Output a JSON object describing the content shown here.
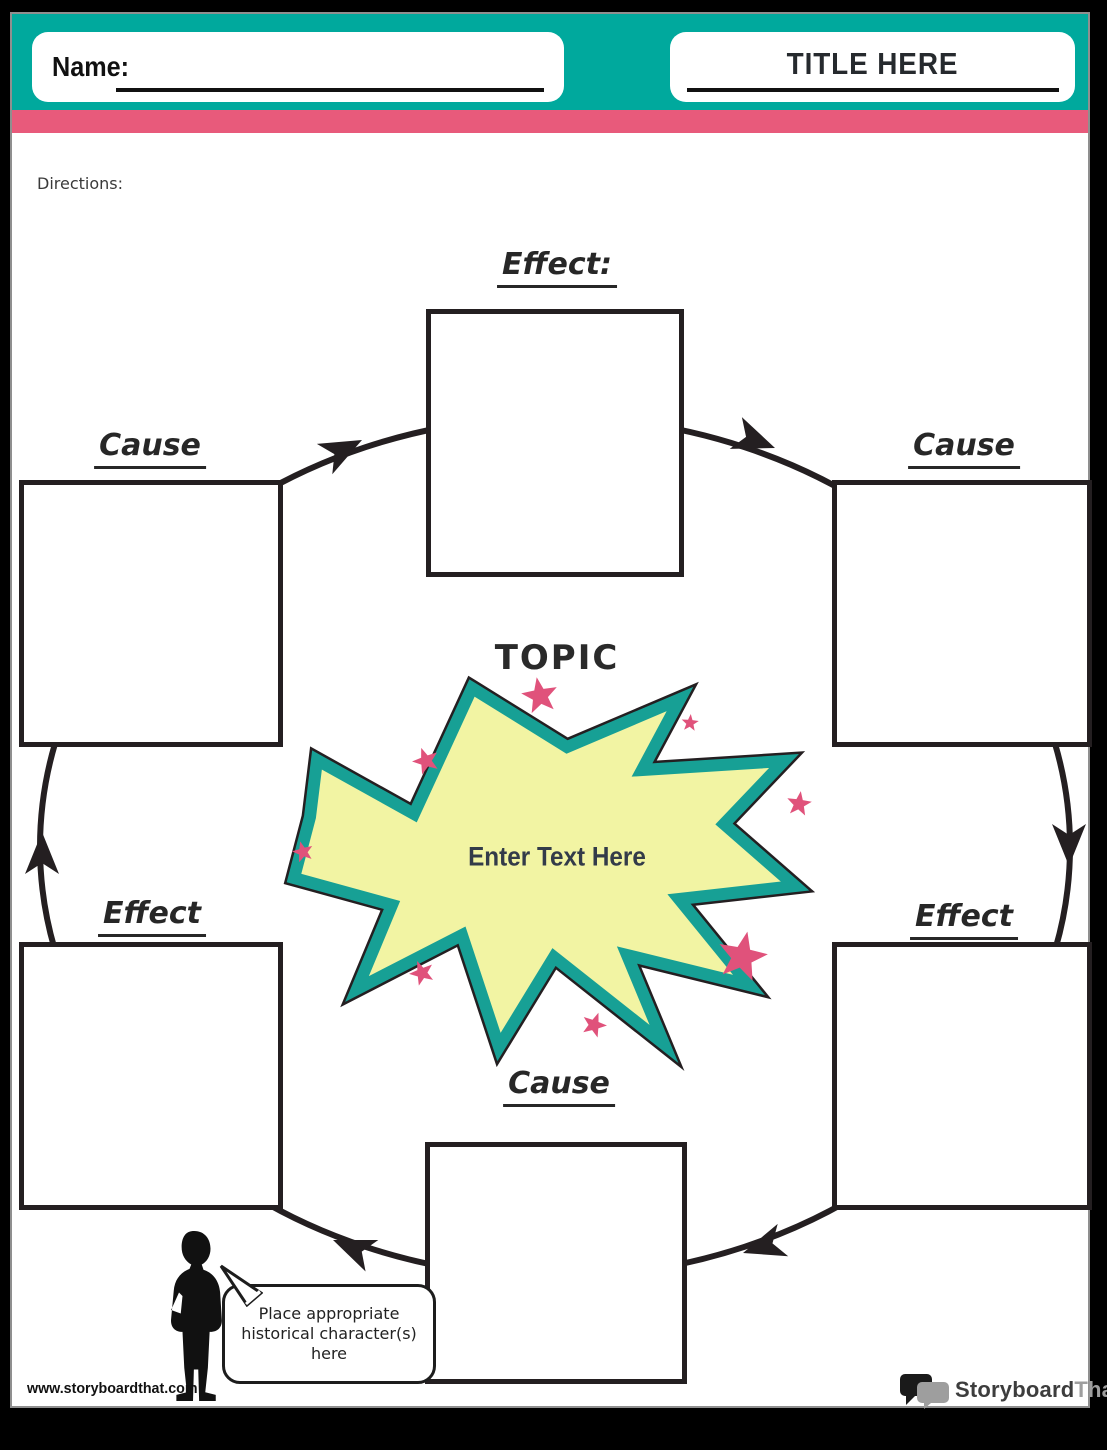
{
  "header": {
    "name_label": "Name:",
    "title": "TITLE HERE"
  },
  "directions_label": "Directions:",
  "diagram": {
    "topic_label": "TOPIC",
    "center_placeholder": "Enter Text Here",
    "labels": {
      "top": "Effect:",
      "left": "Cause",
      "right": "Cause",
      "bottom_left": "Effect",
      "bottom_right": "Effect",
      "bottom": "Cause"
    }
  },
  "speech_bubble": {
    "text": "Place appropriate historical character(s) here"
  },
  "footer": {
    "website": "www.storyboardthat.com",
    "logo_part1": "Storyboard",
    "logo_part2": "That"
  },
  "colors": {
    "teal": "#00a99d",
    "pink": "#e85a7b",
    "burst_teal": "#17a095",
    "burst_yellow": "#f2f4a3",
    "star_pink": "#e0527b",
    "ink": "#241f21",
    "logo_dark": "#3d3d3d",
    "logo_gray": "#9e9e9e"
  }
}
